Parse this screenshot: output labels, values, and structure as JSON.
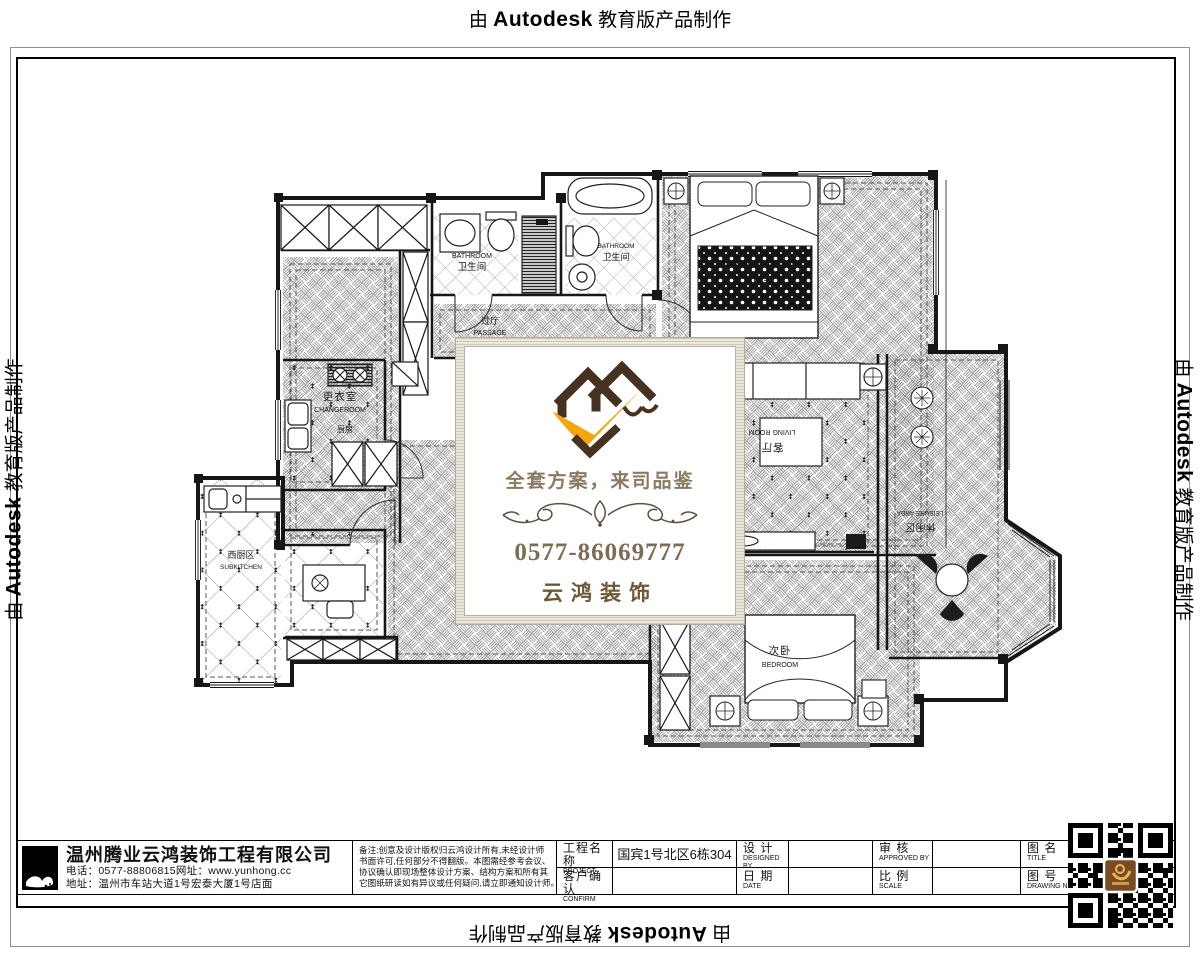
{
  "autodesk": {
    "prefix": "由",
    "brand": "Autodesk",
    "suffix": "教育版产品制作"
  },
  "watermark_card": {
    "slogan": "全套方案，来司品鉴",
    "phone": "0577-86069777",
    "brand": "云鸿装饰",
    "colors": {
      "logo_brown": "#47311f",
      "logo_orange": "#f3a70d",
      "text_brown": "#8a7a60"
    }
  },
  "plan": {
    "rooms": {
      "changeroom": {
        "zh": "更衣室",
        "en": "CHANGEROOM"
      },
      "bath1": {
        "zh": "卫生间",
        "en": "BATHROOM"
      },
      "bath2": {
        "zh": "卫生间",
        "en": "BATHROOM"
      },
      "master": {
        "zh": "主卧",
        "en": "MASTER BEDROOM"
      },
      "passage": {
        "zh": "过厅",
        "en": "PASSAGE"
      },
      "kitchen": {
        "zh": "厨房"
      },
      "subkitchen": {
        "zh": "西厨区",
        "en": "SUBKITCHEN"
      },
      "living": {
        "zh": "客厅",
        "en": "LIVING ROOM"
      },
      "leisure": {
        "zh": "休闲区",
        "en": "LEISURE AREA"
      },
      "bedroom2": {
        "zh": "次卧",
        "en": "BEDROOM"
      }
    }
  },
  "titleblock": {
    "company": {
      "name": "温州腾业云鸿装饰工程有限公司",
      "contact": "电话：0577-88806815网址：www.yunhong.cc",
      "address": "地址：温州市车站大道1号宏泰大厦1号店面"
    },
    "notes": {
      "l1": "备注:创意及设计版权归云鸿设计所有,未经设计师",
      "l2": "书面许可,任何部分不得翻版。本图需经参考会议、",
      "l3": "协议确认即现场整体设计方案、结构方案和所有其",
      "l4": "它图纸研读如有异议或任何疑问,请立即通知设计师。"
    },
    "fields": {
      "project": {
        "zh": "工程名称",
        "en": "PROJECT",
        "value": "国宾1号北区6栋304"
      },
      "confirm": {
        "zh": "客户确认",
        "en": "CONFIRM",
        "value": ""
      },
      "design": {
        "zh": "设 计",
        "en": "DESIGNED BY",
        "value": ""
      },
      "date": {
        "zh": "日 期",
        "en": "DATE",
        "value": ""
      },
      "check": {
        "zh": "审 核",
        "en": "APPROVED BY",
        "value": ""
      },
      "scale": {
        "zh": "比 例",
        "en": "SCALE",
        "value": ""
      },
      "title": {
        "zh": "图 名",
        "en": "TITLE",
        "value": ""
      },
      "no": {
        "zh": "图 号",
        "en": "DRAWING NO",
        "value": ""
      }
    }
  }
}
